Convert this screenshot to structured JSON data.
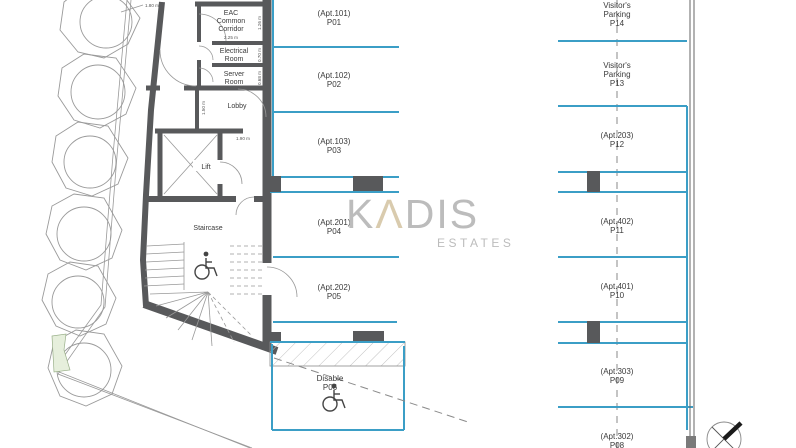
{
  "plan_title": "basement parking floor plan",
  "rooms": {
    "eac_line1": "EAC",
    "eac_line2": "Common",
    "eac_line3": "Corridor",
    "electrical_line1": "Electrical",
    "electrical_line2": "Room",
    "server_line1": "Server",
    "server_line2": "Room",
    "lobby": "Lobby",
    "lift": "Lift",
    "staircase": "Staircase"
  },
  "dimensions": {
    "eac_width": "2.25 m",
    "eac_height": "1.26 m",
    "electrical_height": "0.70 m",
    "server_height": "0.68 m",
    "lobby_height": "1.50 m",
    "corridor_width": "1.90 m",
    "tree_strip": "1.80 m"
  },
  "parking_left": [
    {
      "apt": "(Apt.101)",
      "code": "P01"
    },
    {
      "apt": "(Apt.102)",
      "code": "P02"
    },
    {
      "apt": "(Apt.103)",
      "code": "P03"
    },
    {
      "apt": "(Apt.201)",
      "code": "P04"
    },
    {
      "apt": "(Apt.202)",
      "code": "P05"
    },
    {
      "apt": "Disable",
      "code": "P06"
    }
  ],
  "parking_right": [
    {
      "l1": "Visitor's",
      "l2": "Parking",
      "code": "P14"
    },
    {
      "l1": "Visitor's",
      "l2": "Parking",
      "code": "P13"
    },
    {
      "apt": "(Apt.203)",
      "code": "P12"
    },
    {
      "apt": "(Apt.402)",
      "code": "P11"
    },
    {
      "apt": "(Apt.401)",
      "code": "P10"
    },
    {
      "apt": "(Apt.303)",
      "code": "P09"
    },
    {
      "apt": "(Apt.302)",
      "code": "P08"
    }
  ],
  "watermark": {
    "brand_k": "K",
    "brand_a": "Λ",
    "brand_dis": "DIS",
    "tagline": "ESTATES"
  },
  "colors": {
    "parking_line_blue": "#3B9EC6",
    "wall_gray": "#58595B",
    "watermark_gray": "#BCBCBC",
    "watermark_accent": "#D9CBAE",
    "landscape_green": "#E6EFDC"
  }
}
